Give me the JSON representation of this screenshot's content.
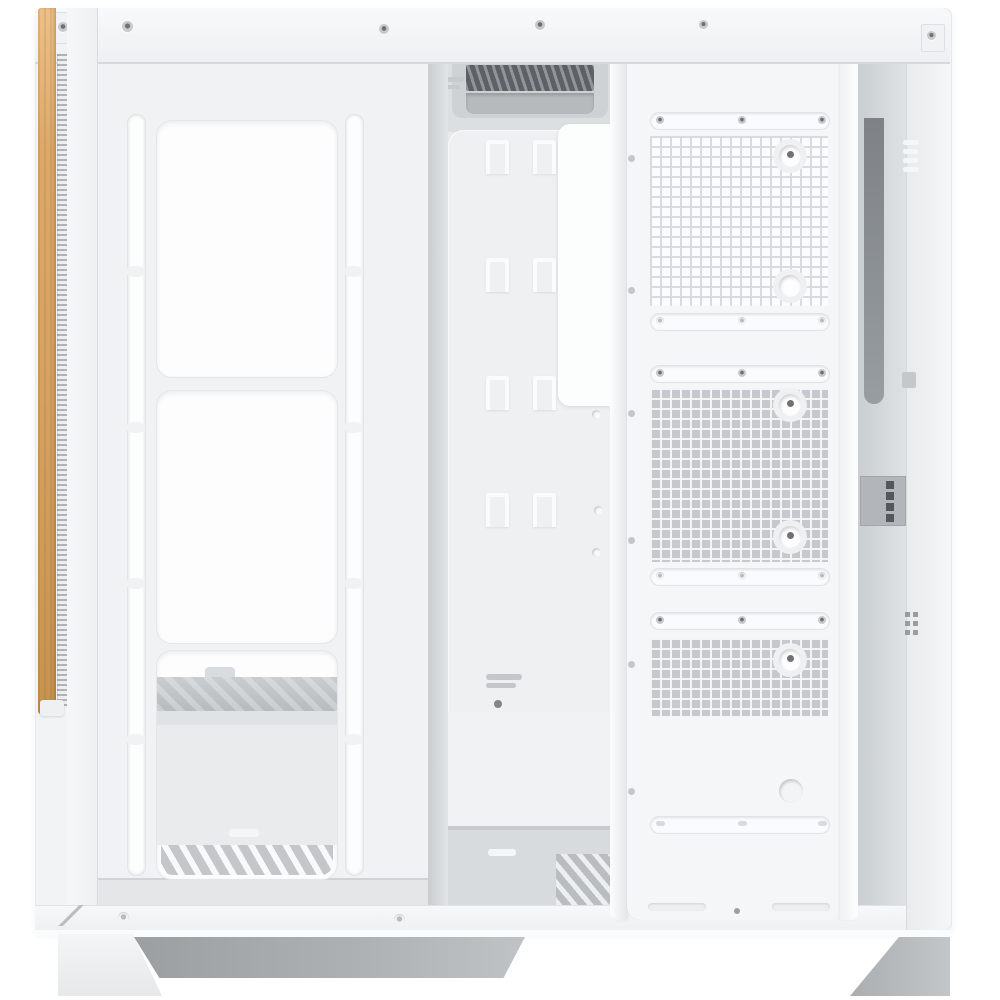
{
  "meta": {
    "type": "product-photo",
    "subject": "White ATX PC case, interior side view with side panel removed, wooden front accent strip",
    "background": "#ffffff"
  },
  "colors": {
    "bg": "#ffffff",
    "case_white": "#f4f6f7",
    "interior": "#e8eaec",
    "wood_light": "#ecc088",
    "wood_mid": "#d5a261",
    "wood_dark": "#c6934f",
    "mesh_open": "#c5c9cd",
    "mesh_line": "#d9dcdf",
    "grille_dark": "#5d6165",
    "base_shadow": "#9b9fa2",
    "screw_dark": "#6e7276"
  },
  "structure": {
    "front_fan_cutouts": 3,
    "front_slot_columns": 2,
    "mesh_sections": 3,
    "mesh_fan_screw_holes": 6,
    "cable_tie_hook_rows": 4,
    "top_vent_grille": 1,
    "bottom_slat_grille": 1,
    "visible_feet": 2
  }
}
